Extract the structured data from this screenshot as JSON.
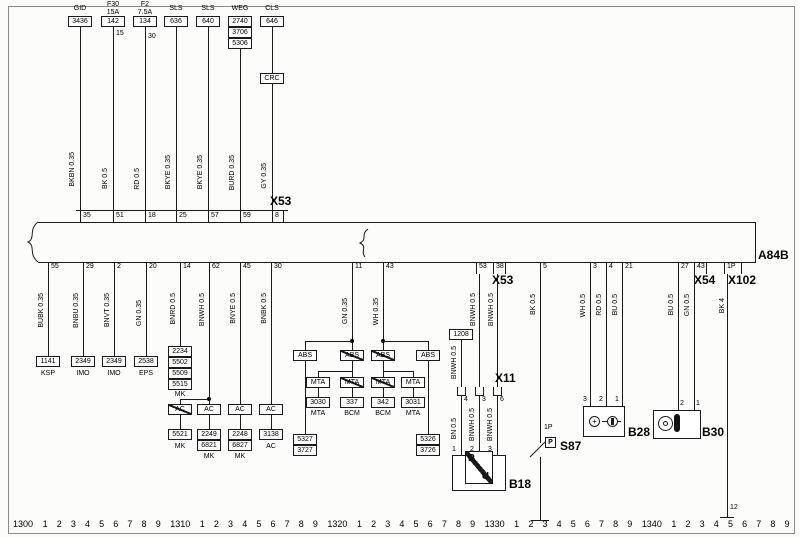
{
  "labels": {
    "a84b": "A84B",
    "x53_top": "X53",
    "x53_bot": "X53",
    "x54": "X54",
    "x102": "X102",
    "x11": "X11",
    "b18": "B18",
    "b28": "B28",
    "b30": "B30",
    "s87": "S87"
  },
  "top": {
    "c1": {
      "t": "GID",
      "box": "3436",
      "wire": "BKBN 0.35",
      "pin": "35"
    },
    "c2": {
      "t": "F30",
      "amp": "15A",
      "box": "142",
      "tap": "15",
      "wire": "BK 0.5",
      "pin": "51"
    },
    "c3": {
      "t": "F2",
      "amp": "7.5A",
      "box": "134",
      "tap": "30",
      "wire": "RD 0.5",
      "pin": "18"
    },
    "c4": {
      "t": "SLS",
      "box": "636",
      "wire": "BKYE 0.35",
      "pin": "25"
    },
    "c5": {
      "t": "SLS",
      "box": "640",
      "wire": "BKYE 0.35",
      "pin": "57"
    },
    "c6": {
      "t": "WEG",
      "b1": "2740",
      "b2": "3706",
      "b3": "5306",
      "wire": "BURD 0.35",
      "pin": "59"
    },
    "c7": {
      "t": "CLS",
      "box": "646",
      "inline": "CRC",
      "wire": "GY 0.35",
      "pin": "8"
    }
  },
  "left": {
    "c1": {
      "wire": "BUBK 0.35",
      "pin": "55",
      "box": "1141",
      "sub": "KSP"
    },
    "c2": {
      "wire": "BNBU 0.35",
      "pin": "29",
      "box": "2349",
      "sub": "IMO"
    },
    "c3": {
      "wire": "BNVT 0.35",
      "pin": "2",
      "box": "2349",
      "sub": "IMO"
    },
    "c4": {
      "wire": "GN 0.35",
      "pin": "20",
      "box": "2538",
      "sub": "EPS"
    },
    "c5": {
      "wire": "BNRD 0.5",
      "pin": "14",
      "s1": "2234",
      "s2": "5502",
      "s3": "5509",
      "s4": "5515",
      "ssub": "MK",
      "ac": "AC",
      "box": "5521",
      "sub": "MK"
    },
    "c6": {
      "wire": "BNWH 0.5",
      "pin": "62",
      "ac": "AC",
      "b1": "2249",
      "b2": "6821",
      "sub": "MK"
    },
    "c7": {
      "wire": "BNYE 0.5",
      "pin": "45",
      "ac": "AC",
      "b1": "2248",
      "b2": "6827",
      "sub": "MK"
    },
    "c8": {
      "wire": "BNBK 0.5",
      "pin": "30",
      "ac": "AC",
      "b1": "3138",
      "sub": "AC"
    }
  },
  "mid": {
    "a": {
      "wire": "GN 0.35",
      "pin": "11",
      "abs_l": "ABS",
      "abs_m": "ABS",
      "mta_l": "MTA",
      "mta_m": "MTA",
      "e1": "5327",
      "e2": "3727",
      "b1": "3030",
      "s1": "MTA",
      "b2": "337",
      "s2": "BCM"
    },
    "b": {
      "wire": "WH 0.35",
      "pin": "43",
      "abs_m": "ABS",
      "abs_r": "ABS",
      "mta_m": "MTA",
      "mta_r": "MTA",
      "e1": "5326",
      "e2": "3726",
      "b1": "342",
      "s1": "BCM",
      "b2": "3031",
      "s2": "MTA"
    }
  },
  "b18": {
    "pin1": "53",
    "pin2": "38",
    "w1": "BNWH 0.5",
    "w2": "BNWH 0.5",
    "ref": "1208",
    "refw": "BNWH 0.5",
    "x11p1": "4",
    "x11p2": "3",
    "x11p3": "6",
    "lw1": "BN 0.5",
    "lw2": "BNWH 0.5",
    "lw3": "BNWH 0.5",
    "dp1": "1",
    "dp2": "2",
    "dp3": "3",
    "p": "P",
    "u": "U"
  },
  "s87": {
    "pin": "5",
    "wire": "BK 0.5",
    "tap": "1P",
    "p": "P"
  },
  "b28": {
    "pin1": "3",
    "pin2": "4",
    "pin3": "21",
    "w1": "WH 0.5",
    "w2": "RD 0.5",
    "w3": "BU 0.5",
    "dp1": "3",
    "dp2": "2",
    "dp3": "1",
    "sym": "+"
  },
  "b30": {
    "pin1": "27",
    "pin2": "43",
    "w1": "BU 0.5",
    "w2": "GN 0.5",
    "dp1": "2",
    "dp2": "1"
  },
  "x102": {
    "pin": "1P",
    "wire": "BK 4",
    "end": "12"
  },
  "ruler": {
    "majors": [
      "1300",
      "1310",
      "1320",
      "1330",
      "1340"
    ],
    "minors": [
      "1",
      "2",
      "3",
      "4",
      "5",
      "6",
      "7",
      "8",
      "9"
    ]
  }
}
